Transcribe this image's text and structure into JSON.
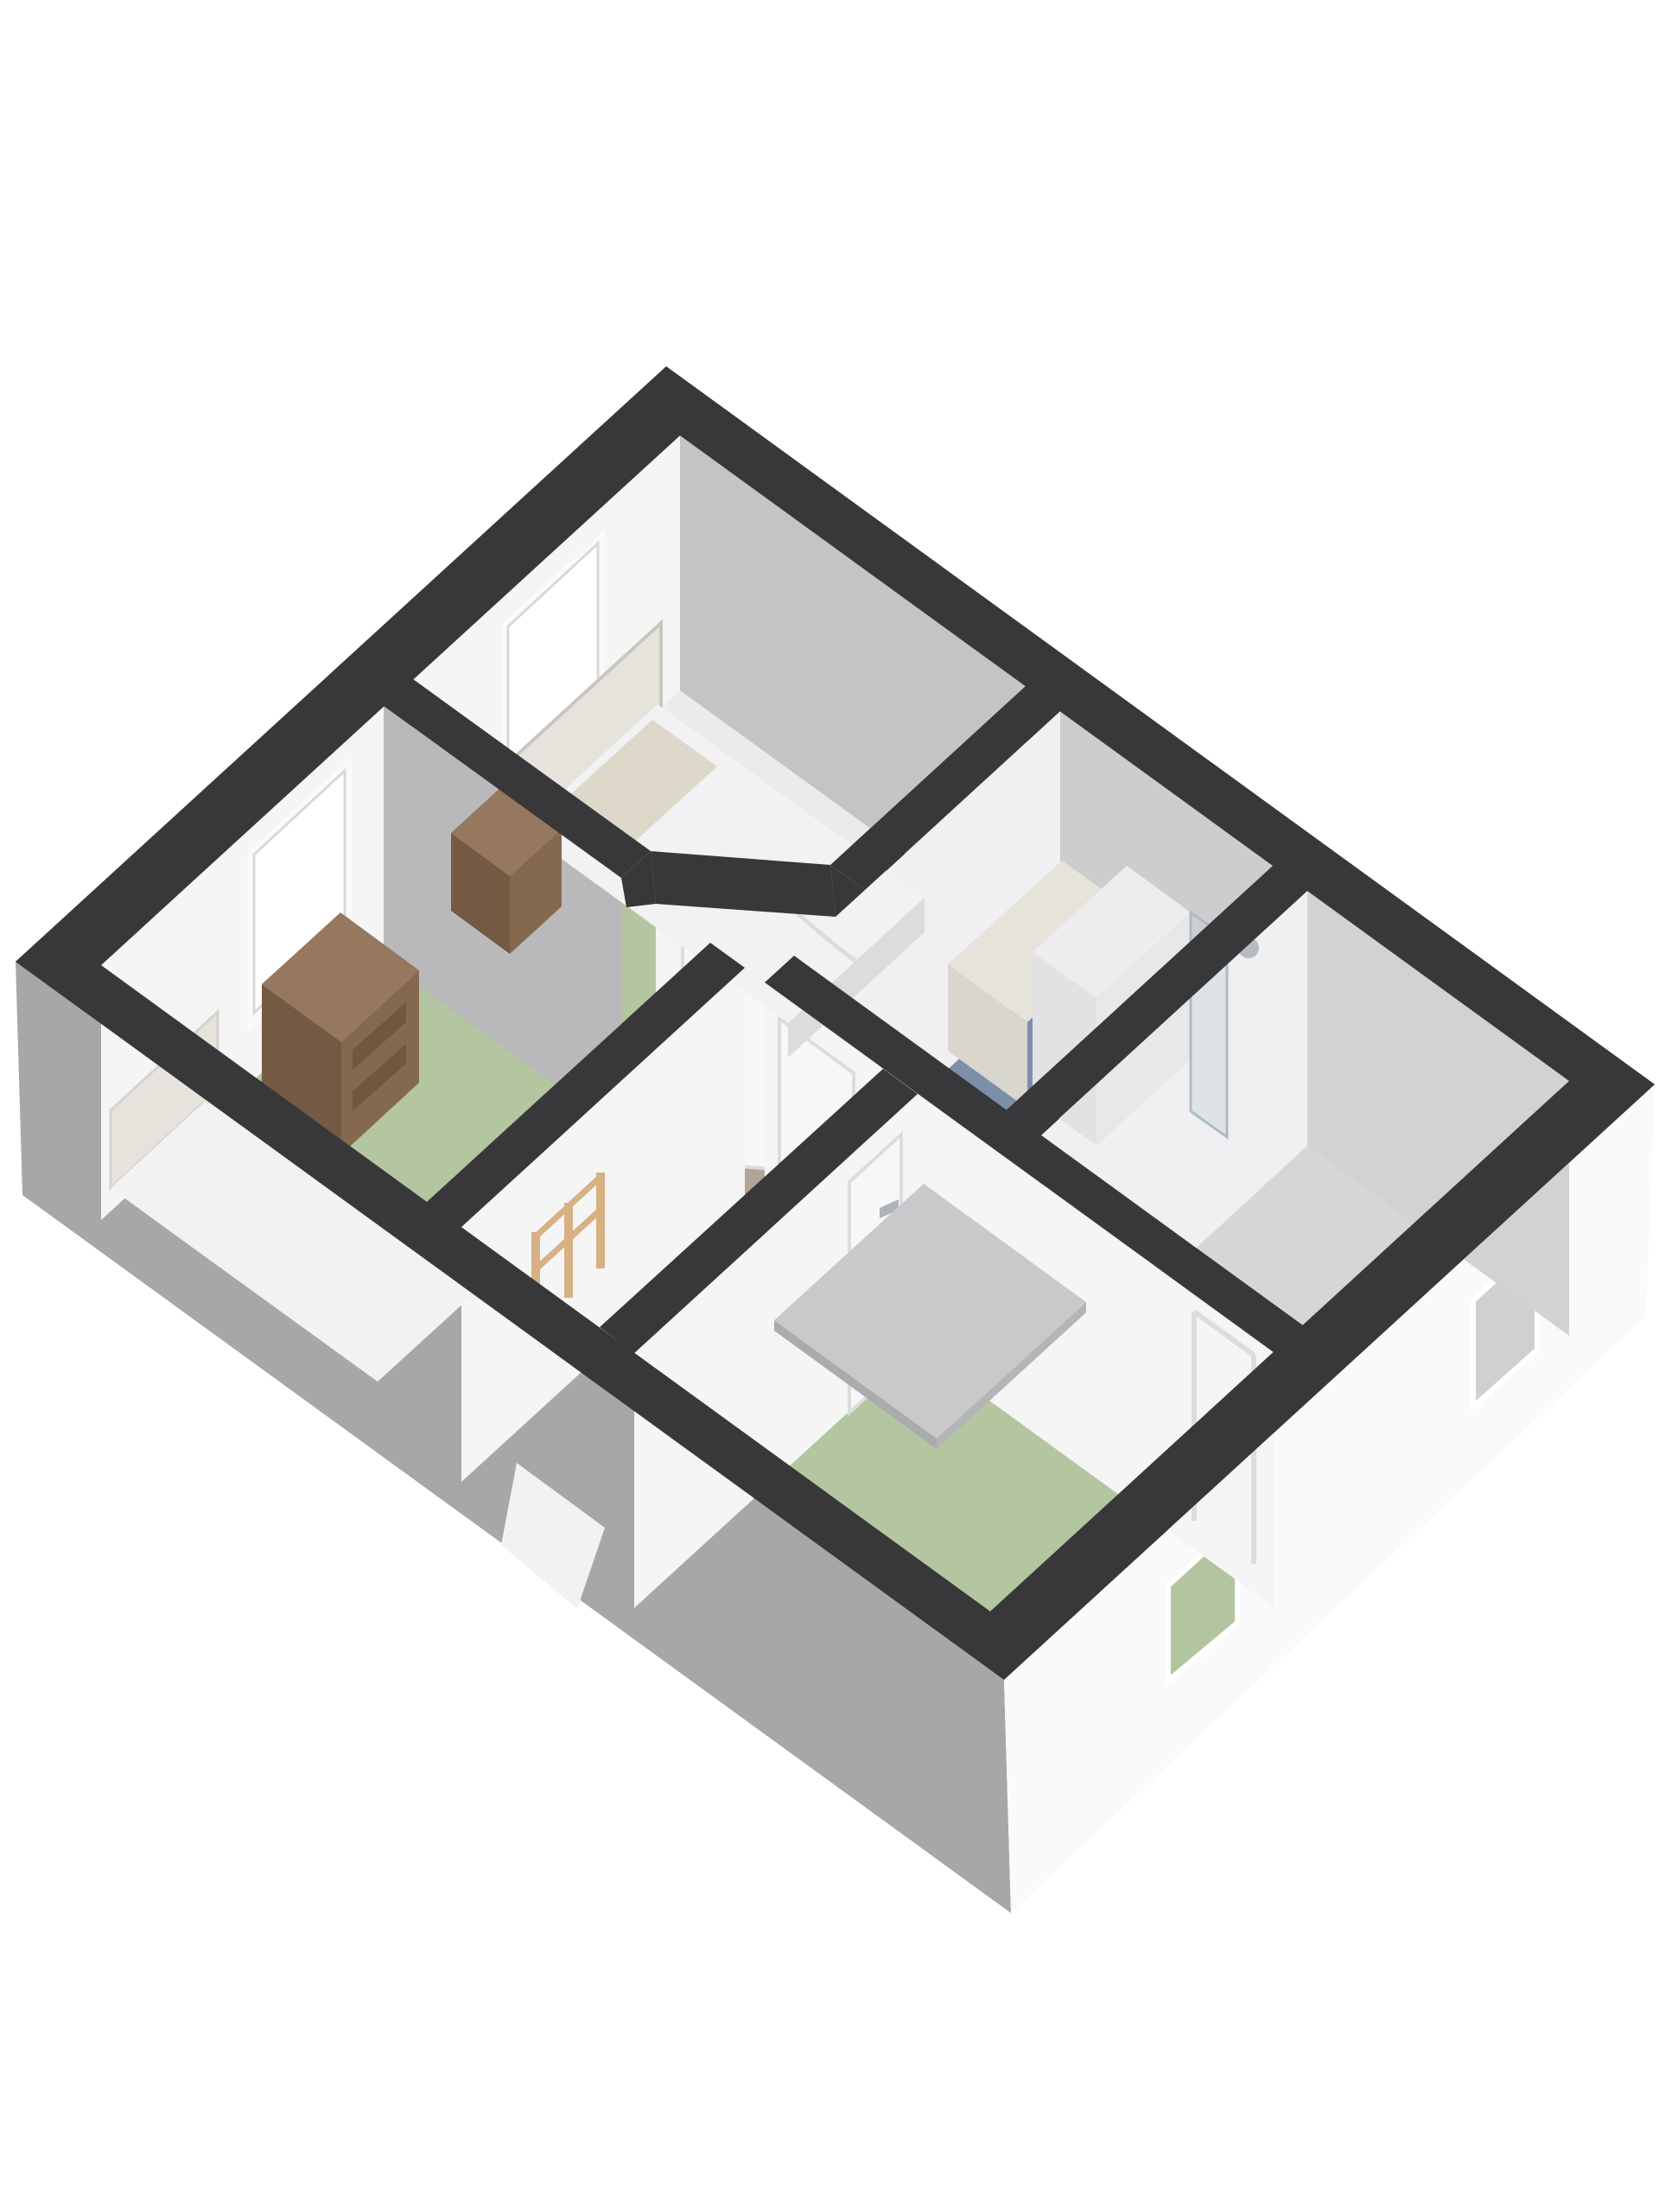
{
  "scene": {
    "background": "#ffffff",
    "view": "3d-floorplan-isometric"
  },
  "colors": {
    "background": "#ffffff",
    "band": "#38383a",
    "extSE": "#fafafa",
    "extSW": "#a7a7a9",
    "bulkhead": "#f2f2f2",
    "floorTopBedroom": "#ebebed",
    "floorGreen": "#b3c6a0",
    "floorHall": "#b3a595",
    "stairOpening": "#ab9e8c",
    "floorBath": "#7b8fa9",
    "floorShower": "#cbcbcd",
    "floorRight": "#d6d6d8",
    "wallWhite": "#f5f5f6",
    "wallWhiteSoft": "#f0f0f2",
    "wallGrayNE": "#c4c4c6",
    "wallGrayBathNE": "#cdcdcf",
    "wallGrayRightNE": "#d2d2d4",
    "wallGrayW1": "#b9b9bb",
    "windowFrame": "#fafafa",
    "windowPane": "#ffffff",
    "windowPaneGreen": "#b3c4a1",
    "windowPaneGray": "#d0d0d2",
    "door": "#f7f7f9",
    "handle": "#aeb3b8",
    "woodTop": "#96785f",
    "woodSE": "#85694f",
    "woodSW": "#745a43",
    "drawer": "#6f5740",
    "railWood": "#d7b083",
    "bedWhite": "#f2f2f4",
    "bedSide": "#dcdcde",
    "pillow": "#ded8ca",
    "headboard": "#e6e3dd",
    "headboardFrame": "#c9c6c0",
    "counterTop": "#e5e3da",
    "counterSide": "#d8d6cd",
    "cabinetTop": "#ededef",
    "cabinetSW": "#e2e2e4",
    "cabinetSE": "#e8e8ea",
    "glass": "#c6d2da",
    "chrome": "#b6bbc0",
    "platformTop": "#c9c9cb",
    "platformSE": "#b5b5b7",
    "platformSW": "#ababad",
    "stepLine": "#a79a87"
  },
  "rooms": {
    "top_bedroom_floor": "#ebebed",
    "left_bedroom_floor": "#b3c6a0",
    "hallway_floor": "#b3a595",
    "bathroom_floor": "#7b8fa9",
    "right_room_floor": "#d6d6d8",
    "bottom_bedroom_floor": "#b3c6a0"
  }
}
